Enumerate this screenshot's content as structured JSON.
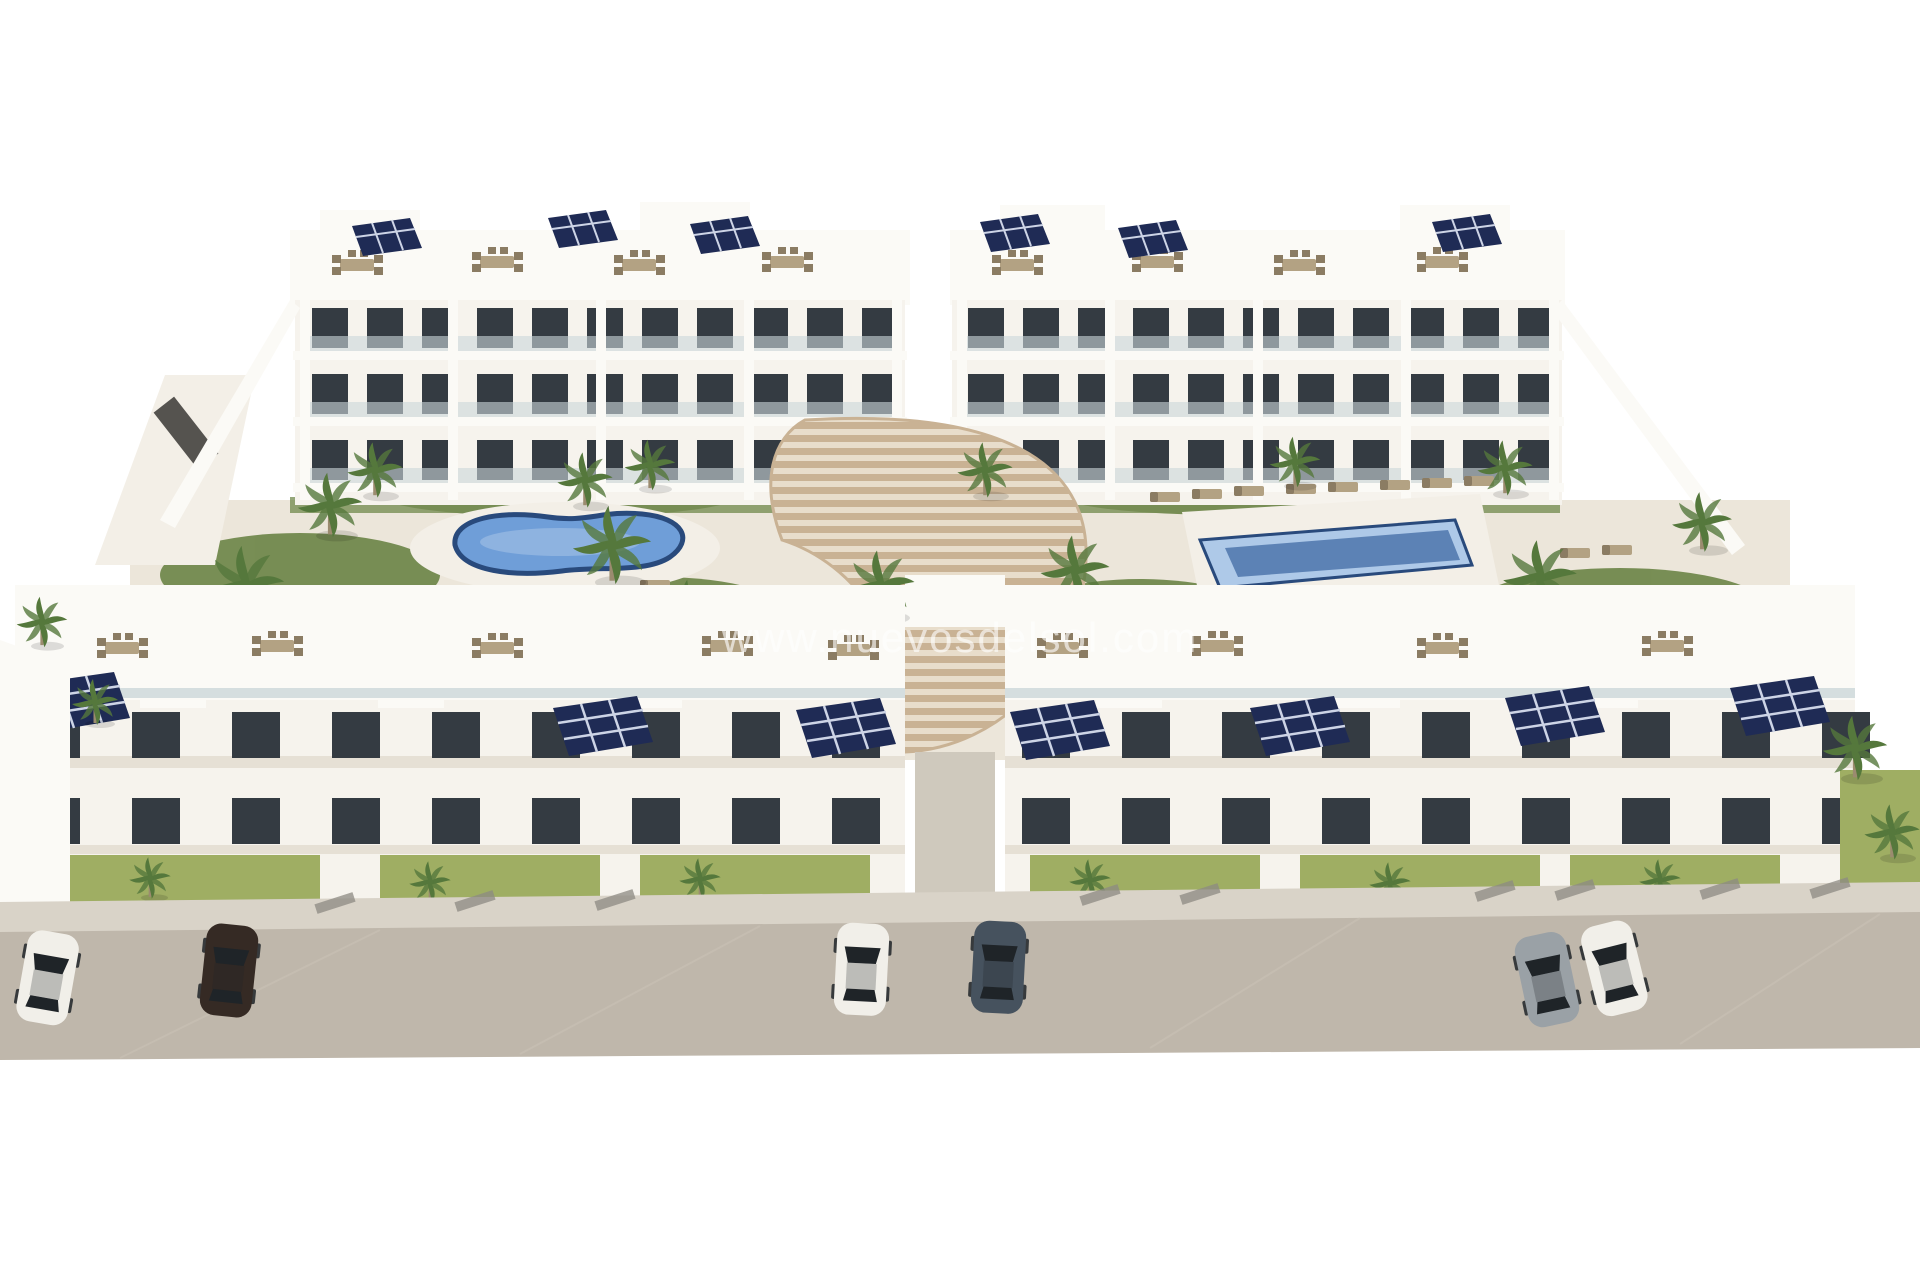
{
  "watermark": {
    "text": "www.nuevosdelsol.com"
  },
  "colors": {
    "sky": "#ffffff",
    "facade": "#f6f3ed",
    "facade_bright": "#fbfaf6",
    "facade_shade": "#e6e0d5",
    "outline": "#e2dcd1",
    "window": "#343b42",
    "glass": "#ccd7da",
    "solar": "#1f2b55",
    "solar_grid": "#cdd4e6",
    "pool_water": "#6f9ed8",
    "pool_rim": "#294a7c",
    "pool_shallow": "#aec9e8",
    "pool_deep": "#5c82b5",
    "deck": "#f3efe7",
    "ground": "#ece6da",
    "lawn": "#9fae63",
    "grass_dark": "#6b8446",
    "foliage": "#55783c",
    "trunk": "#9b8b6f",
    "steps": "#c9b294",
    "steps_light": "#e8ddcb",
    "road": "#bfb7ab",
    "road_seam": "#cac2b5",
    "sidewalk": "#d9d3c8",
    "curb": "#8d8a83",
    "walkway": "#cfc9bd",
    "furniture": "#b3a283",
    "furniture_dark": "#8b7c63",
    "pergola_dark": "#55534f",
    "car_white": "#f1efe9",
    "car_brown": "#352a24",
    "car_slate": "#46525e",
    "car_silver": "#9aa1a6",
    "car_glass": "#1f2428",
    "shadow": "#000000"
  }
}
